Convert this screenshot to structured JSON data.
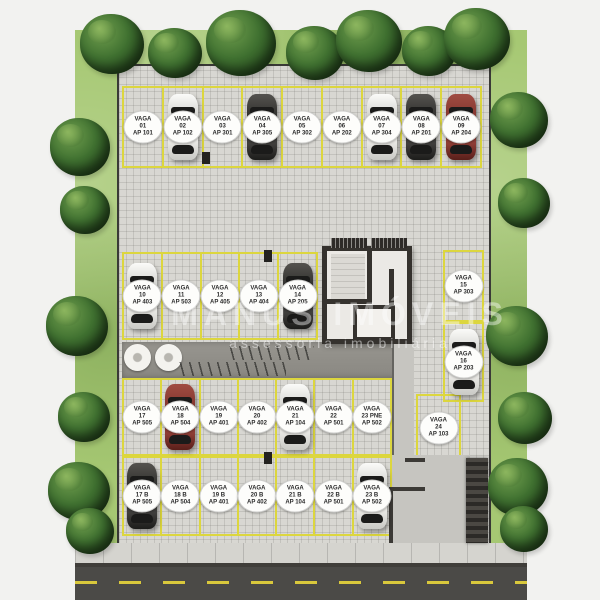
{
  "watermark": {
    "line1": "MANUS IMÓVEIS",
    "line2": "assessoria imobiliária"
  },
  "badge_word": "VAGA",
  "rows": {
    "top": [
      {
        "vaga": "01",
        "ap": "AP 101",
        "car": null
      },
      {
        "vaga": "02",
        "ap": "AP 102",
        "car": "white"
      },
      {
        "vaga": "03",
        "ap": "AP 301",
        "car": null
      },
      {
        "vaga": "04",
        "ap": "AP 305",
        "car": "dark"
      },
      {
        "vaga": "05",
        "ap": "AP 302",
        "car": null
      },
      {
        "vaga": "06",
        "ap": "AP 202",
        "car": null
      },
      {
        "vaga": "07",
        "ap": "AP 304",
        "car": "white"
      },
      {
        "vaga": "08",
        "ap": "AP 201",
        "car": "dark"
      },
      {
        "vaga": "09",
        "ap": "AP 204",
        "car": "red"
      }
    ],
    "middle": [
      {
        "vaga": "10",
        "ap": "AP 403",
        "car": "white"
      },
      {
        "vaga": "11",
        "ap": "AP 503",
        "car": null
      },
      {
        "vaga": "12",
        "ap": "AP 405",
        "car": null
      },
      {
        "vaga": "13",
        "ap": "AP 404",
        "car": null
      },
      {
        "vaga": "14",
        "ap": "AP 205",
        "car": "dark"
      }
    ],
    "side_right": [
      {
        "vaga": "15",
        "ap": "AP 303",
        "car": null
      },
      {
        "vaga": "16",
        "ap": "AP 203",
        "car": "white"
      },
      {
        "vaga": "24",
        "ap": "AP 103",
        "car": null
      }
    ],
    "third": [
      {
        "vaga": "17",
        "ap": "AP 505",
        "car": null
      },
      {
        "vaga": "18",
        "ap": "AP 504",
        "car": "red"
      },
      {
        "vaga": "19",
        "ap": "AP 401",
        "car": null
      },
      {
        "vaga": "20",
        "ap": "AP 402",
        "car": null
      },
      {
        "vaga": "21",
        "ap": "AP 104",
        "car": "white"
      },
      {
        "vaga": "22",
        "ap": "AP 501",
        "car": null
      },
      {
        "vaga": "23 PNE",
        "ap": "AP 502",
        "car": null
      }
    ],
    "bottom": [
      {
        "vaga": "17 B",
        "ap": "AP 505",
        "car": "dark"
      },
      {
        "vaga": "18 B",
        "ap": "AP 504",
        "car": null
      },
      {
        "vaga": "19 B",
        "ap": "AP 401",
        "car": null
      },
      {
        "vaga": "20 B",
        "ap": "AP 402",
        "car": null
      },
      {
        "vaga": "21 B",
        "ap": "AP 104",
        "car": null
      },
      {
        "vaga": "22 B",
        "ap": "AP 501",
        "car": null
      },
      {
        "vaga": "23 B",
        "ap": "AP 502",
        "car": "white"
      }
    ]
  },
  "colors": {
    "line_yellow": "#dcd63e",
    "grass": "#a6c873",
    "paver": "#d8d7d2",
    "asphalt": "#4b4a47",
    "car_white": "#ecebe7",
    "car_dark": "#2a2a28",
    "car_red": "#8e3d35"
  }
}
